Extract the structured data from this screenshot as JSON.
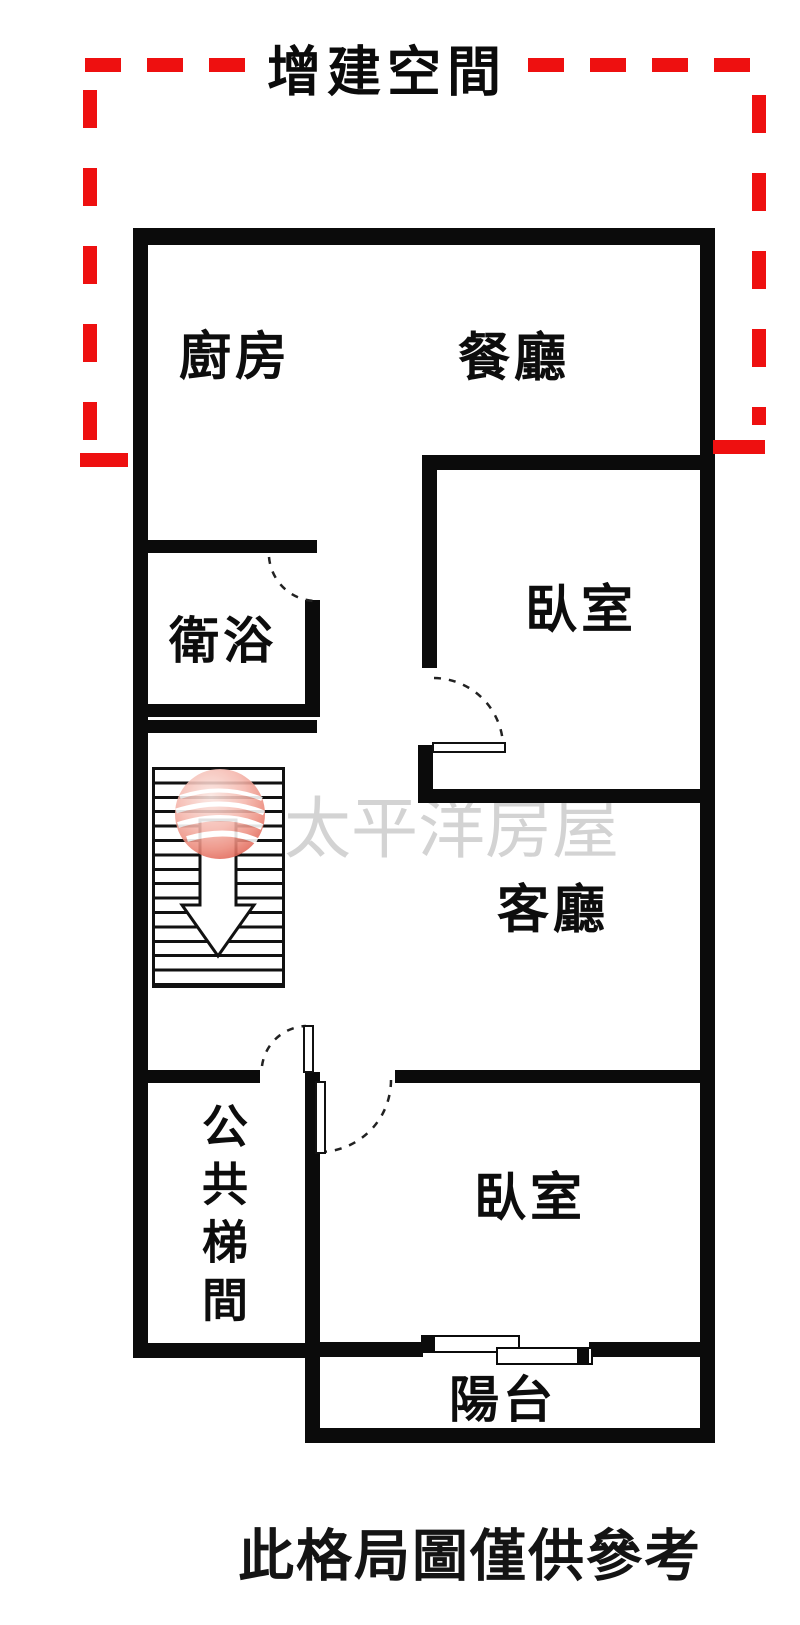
{
  "annotation": {
    "label": "增建空間",
    "color": "#ee1010"
  },
  "rooms": {
    "kitchen": "廚房",
    "dining": "餐廳",
    "bathroom": "衛浴",
    "bedroom_upper": "臥室",
    "living_room": "客廳",
    "public_stairwell": "公共梯間",
    "bedroom_lower": "臥室",
    "balcony": "陽台"
  },
  "watermark": {
    "brand": "太平洋房屋"
  },
  "caption": {
    "text": "此格局圖僅供參考"
  },
  "colors": {
    "wall": "#0b0b0b",
    "annotation_red": "#ee1010",
    "watermark_text": "#d3d3d3",
    "logo_red": "#e06152"
  }
}
